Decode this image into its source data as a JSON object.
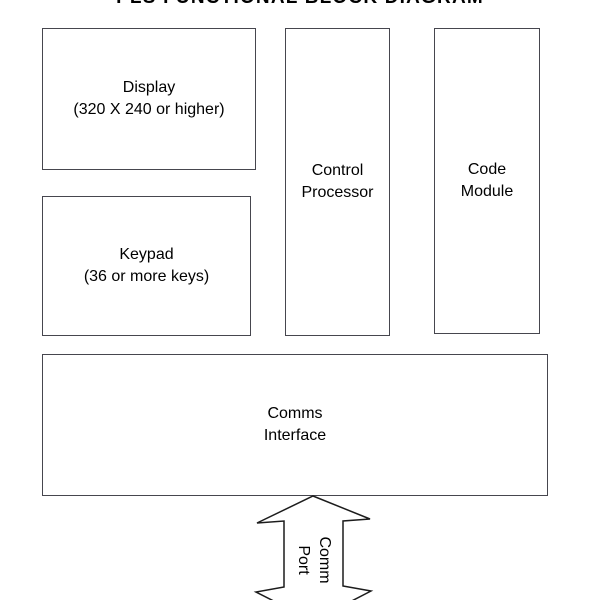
{
  "title": "PLS FUNCTIONAL BLOCK DIAGRAM",
  "blocks": {
    "display": {
      "line1": "Display",
      "line2": "(320 X 240 or higher)"
    },
    "keypad": {
      "line1": "Keypad",
      "line2": "(36 or more keys)"
    },
    "control_processor": {
      "line1": "Control",
      "line2": "Processor"
    },
    "code_module": {
      "line1": "Code",
      "line2": "Module"
    },
    "comms_interface": {
      "line1": "Comms",
      "line2": "Interface"
    }
  },
  "connector": {
    "label_line1": "Comm",
    "label_line2": "Port",
    "type": "double-headed-vertical-arrow"
  },
  "colors": {
    "background": "#ffffff",
    "box_border": "#46464e",
    "arrow_line": "#1c1c1c",
    "text": "#000000"
  }
}
